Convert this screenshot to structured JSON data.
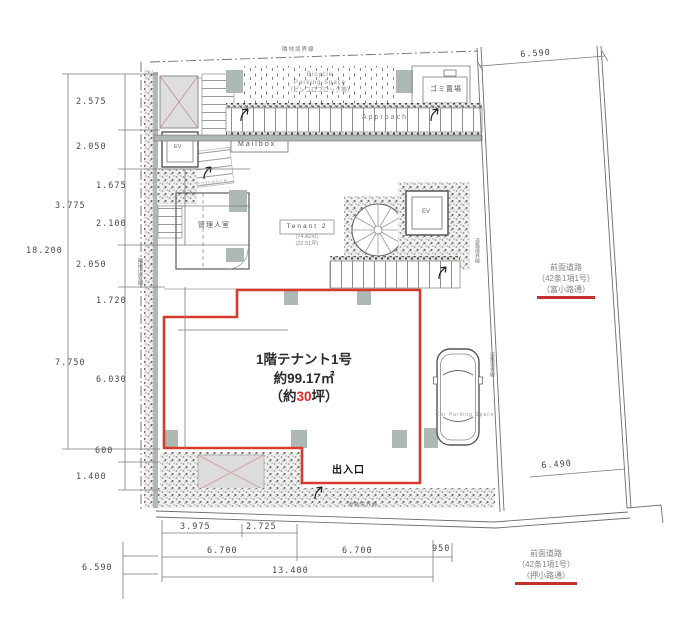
{
  "colors": {
    "tenant_outline_red": "#d93a2e",
    "tsubo_number_red": "#e02a20",
    "road_underline_red": "#c4302b",
    "wall_gray_green": "#aeb9b4"
  },
  "plan": {
    "tenant1": {
      "title": "1階テナント1号",
      "area": "約99.17㎡",
      "tsubo_pre": "（約",
      "tsubo_num": "30",
      "tsubo_post": "坪）"
    },
    "tenant2": {
      "name": "Tenant 2",
      "area": "(74.42㎡)",
      "tsubo": "(22.51坪)"
    },
    "labels": {
      "manager_room": "管理人室",
      "garbage": "ゴミ置場",
      "ev_left": "EV",
      "ev_right": "EV",
      "entrance": "Entrance",
      "mailbox": "Mailbox",
      "approach": "Approach",
      "bicycle_line1": "Bicycle",
      "bicycle_line2": "Parking Space",
      "bicycle_line3": "（ピンコロブロック等）",
      "car_parking": "Car Parking Space",
      "exit": "出入口"
    },
    "boundaries": {
      "top": "隣地境界線",
      "left": "隣地境界線",
      "road_bottom": "道路境界線",
      "road_right_upper": "道路境界線",
      "road_right_lower": "道路境界線"
    },
    "roads": {
      "right": {
        "line1": "前面道路",
        "line2": "（42条1項1号）",
        "line3": "（富小路通）"
      },
      "bottom": {
        "line1": "前面道路",
        "line2": "（42条1項1号）",
        "line3": "（押小路通）"
      }
    }
  },
  "dimensions": {
    "left_total": "18.200",
    "left_1": "2.575",
    "left_2": "2.050",
    "left_3": "1.675",
    "left_4": "3.775",
    "left_5": "2.100",
    "left_6": "2.050",
    "left_7": "1.720",
    "left_8": "7.750",
    "left_9": "6.030",
    "left_10": "600",
    "left_11": "1.400",
    "bottom_1": "3.975",
    "bottom_2": "2.725",
    "bottom_3": "6.700",
    "bottom_4": "6.700",
    "bottom_5": "950",
    "bottom_total": "13.400",
    "bottom_left_road": "6.590",
    "top_right": "6.590",
    "right_side": "6.490"
  }
}
